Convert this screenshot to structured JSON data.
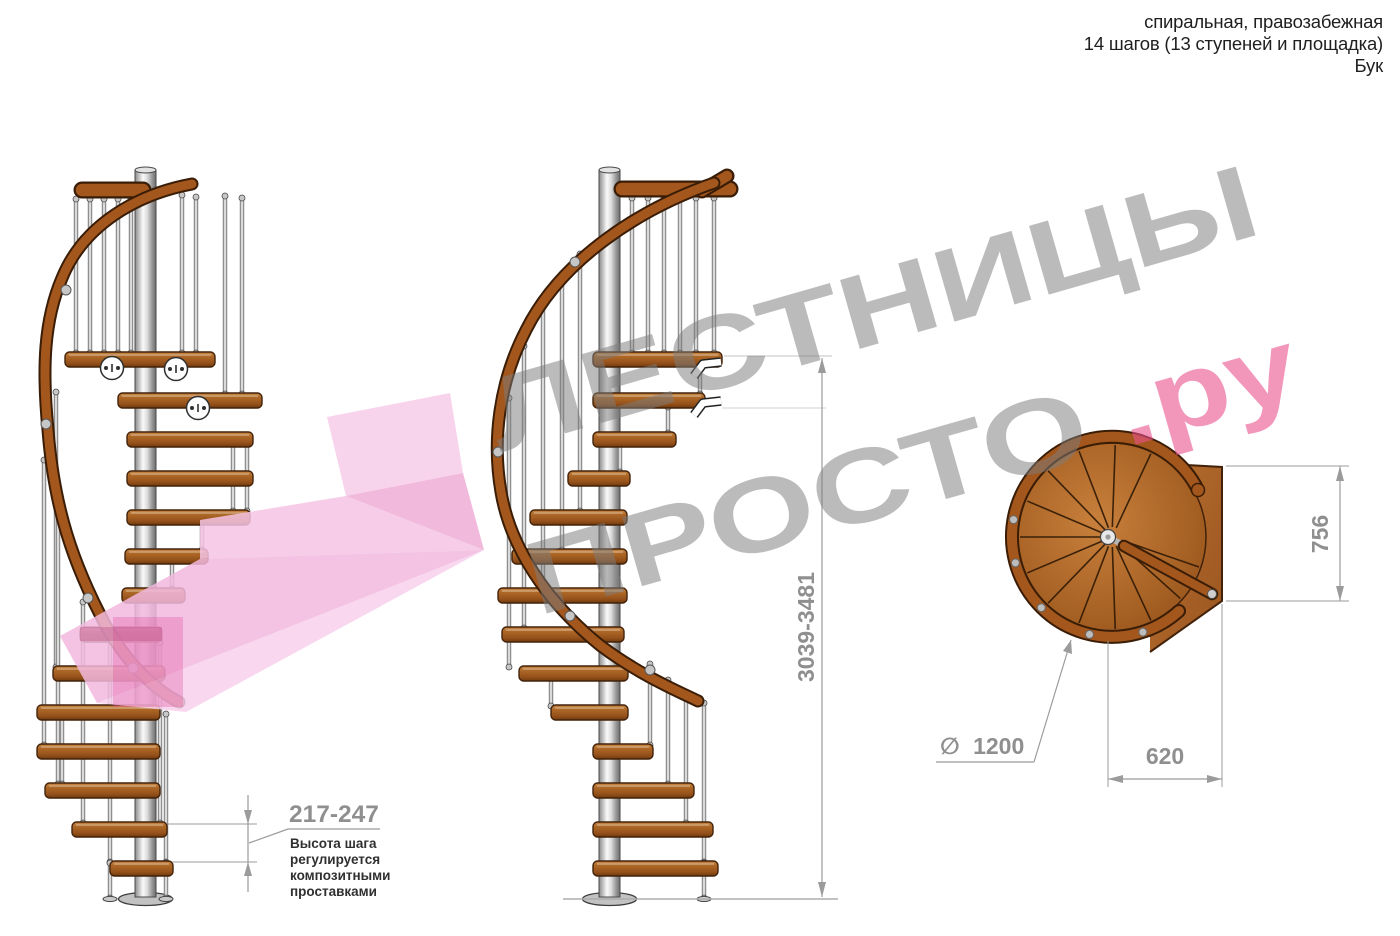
{
  "header": {
    "line1": "спиральная, правозабежная",
    "line2": "14 шагов (13 ступеней и площадка)",
    "line3": "Бук"
  },
  "watermark": {
    "line1": "ЛЕСТНИЦЫ",
    "line2_gray": "ПРОСТО",
    "line2_pink": ".ру"
  },
  "dimensions": {
    "total_height": "3039-3481",
    "step_height": "217-247",
    "step_note": [
      "Высота шага",
      "регулируется",
      "композитными",
      "проставками"
    ],
    "diameter_symbol": "∅",
    "diameter_value": "1200",
    "landing_width": "620",
    "landing_depth": "756"
  },
  "colors": {
    "wood": "#a4571c",
    "metal": "#d9d9d9",
    "pink_arrow": "#f2b8dc",
    "watermark_gray": "#7d7d7d",
    "watermark_pink": "#e95b96",
    "dimension_gray": "#8f8f8f"
  }
}
